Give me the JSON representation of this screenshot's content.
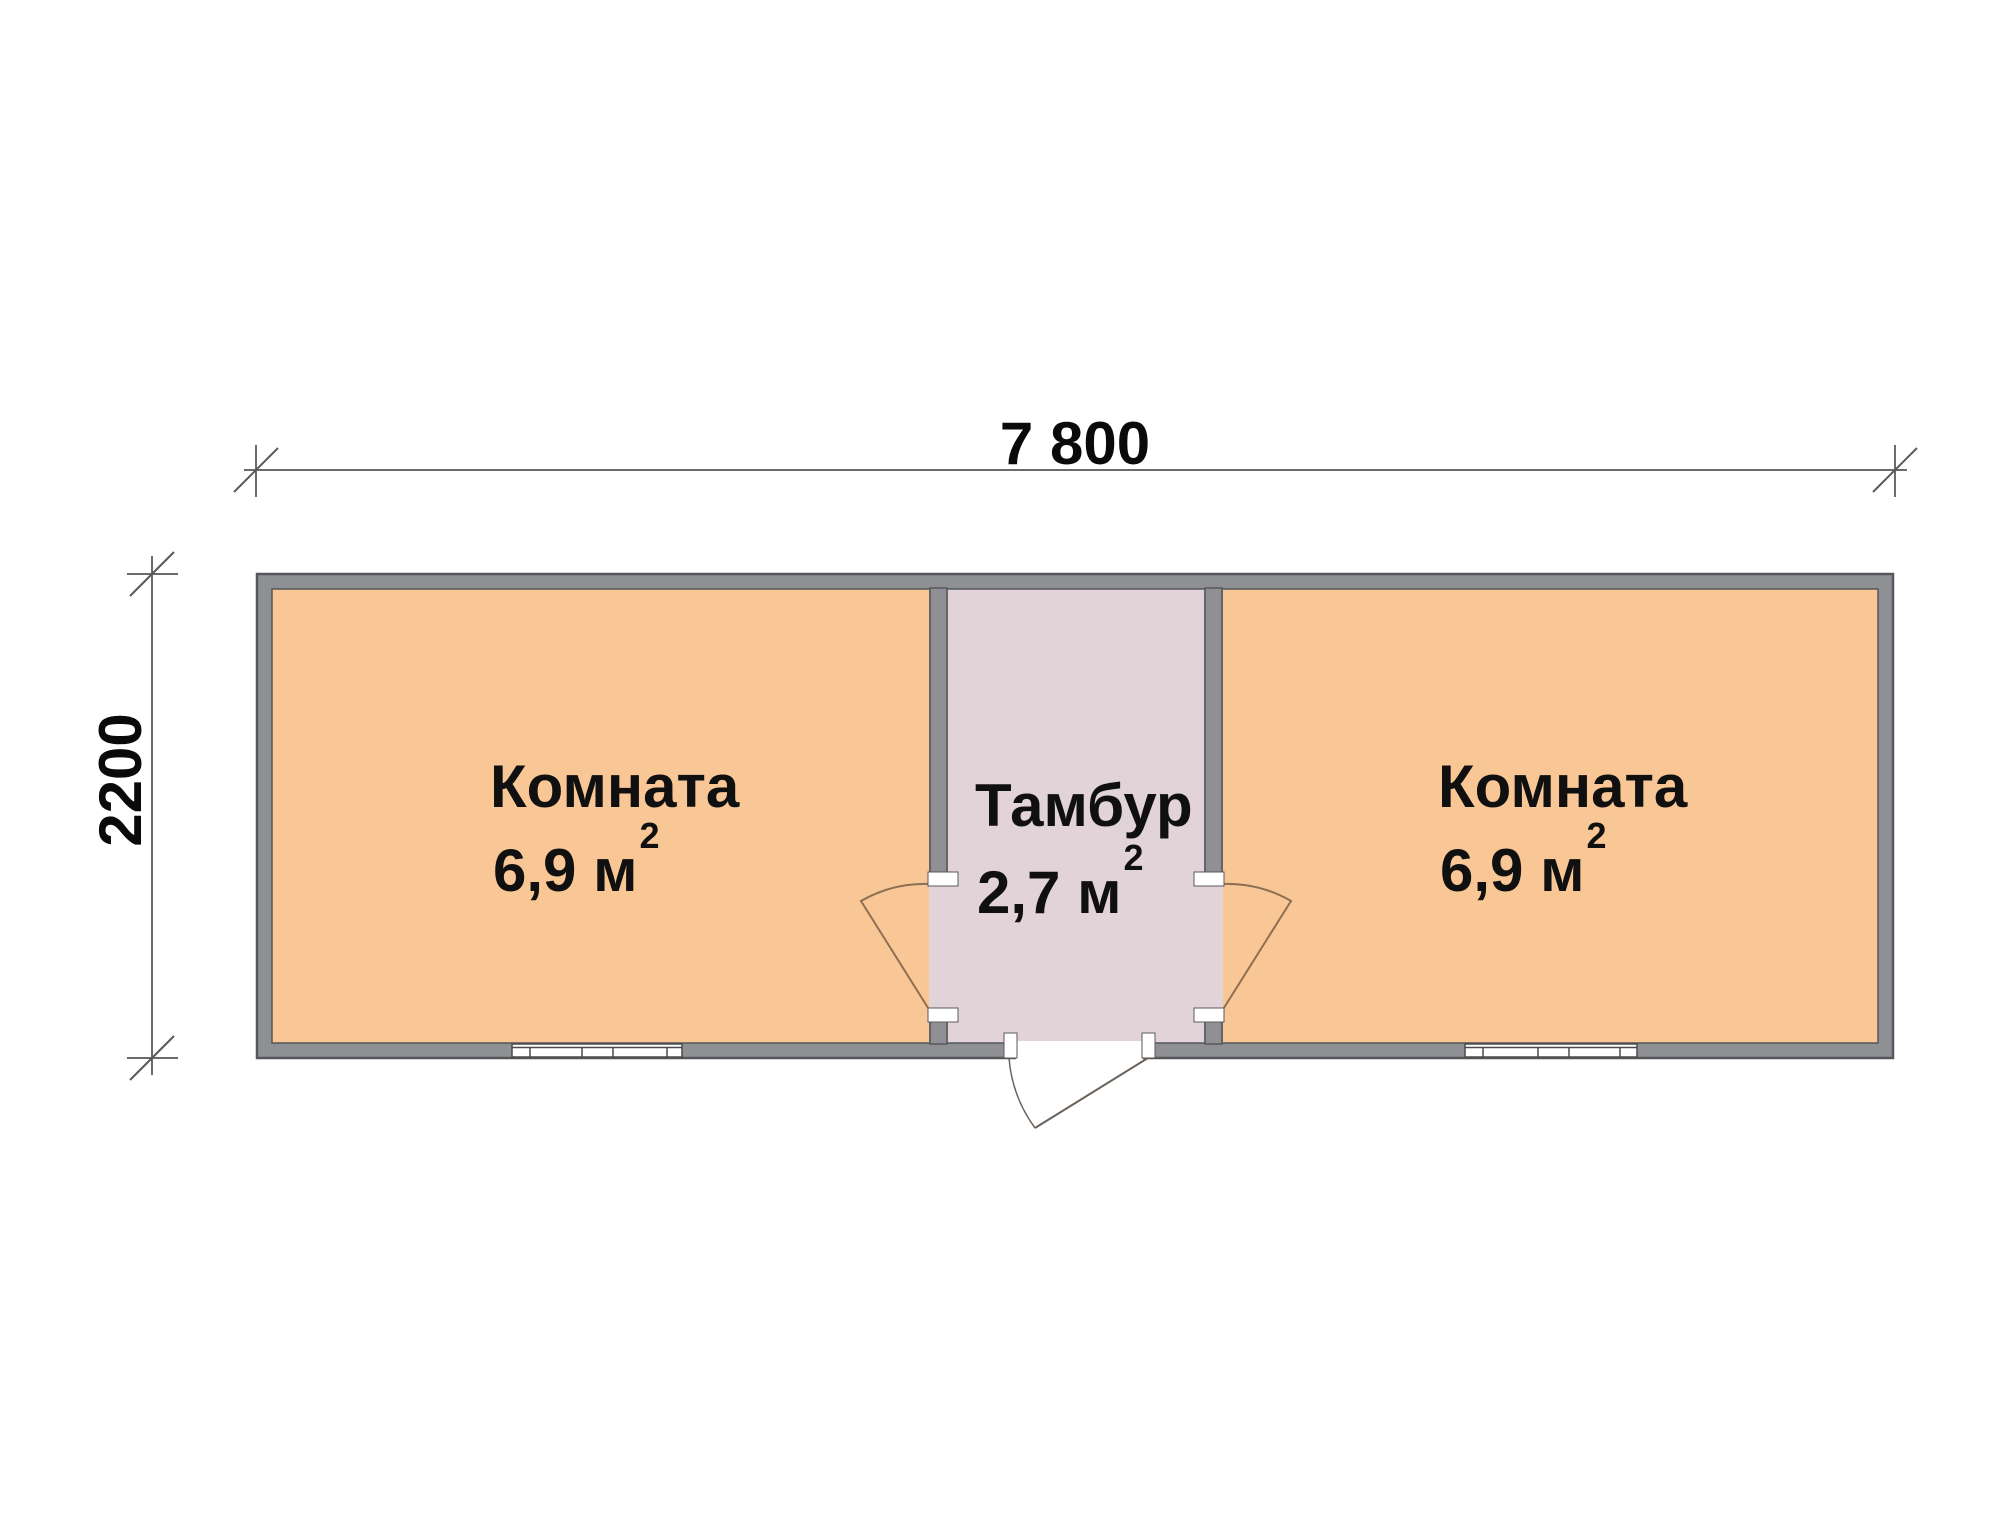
{
  "drawing": {
    "type": "floor-plan",
    "dimensions": {
      "width_label": "7 800",
      "height_label": "2200"
    },
    "rooms": {
      "left": {
        "name": "Комната",
        "area": "6,9 м",
        "area_exp": "2"
      },
      "vestibule": {
        "name": "Тамбур",
        "area": "2,7 м",
        "area_exp": "2"
      },
      "right": {
        "name": "Комната",
        "area": "6,9 м",
        "area_exp": "2"
      }
    },
    "colors": {
      "room_fill": "#F9C795",
      "vestibule_fill": "#E2D3D9",
      "wall_fill": "#8F9094",
      "wall_outline": "#54565A",
      "dim_line": "#3A3A3A",
      "door_line": "#8B6F52",
      "window_line": "#4A4A4A"
    }
  }
}
